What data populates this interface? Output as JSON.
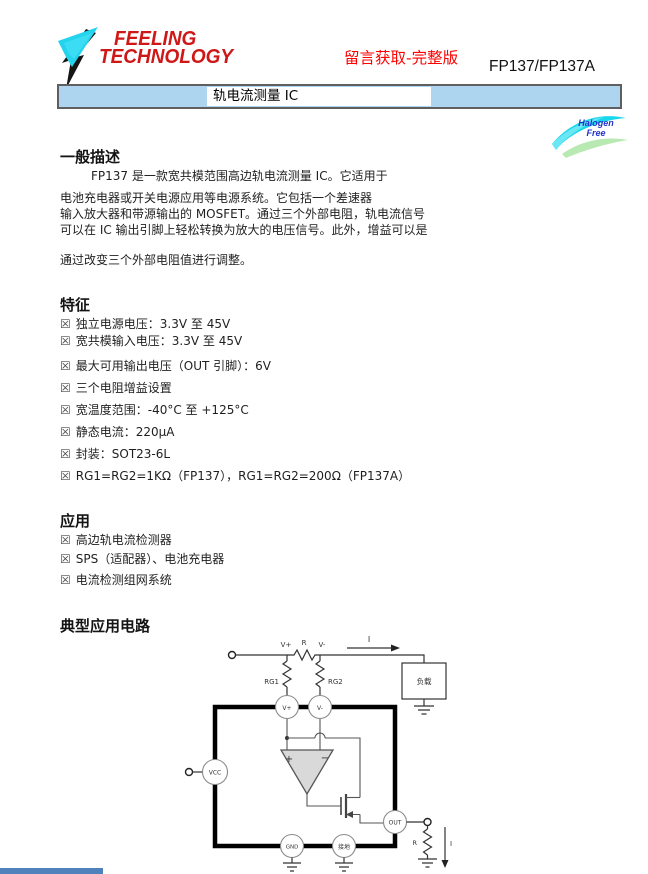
{
  "header": {
    "logo_line1": "FEELING",
    "logo_line2": "TECHNOLOGY",
    "promo_text": "留言获取-完整版",
    "part_number": "FP137/FP137A",
    "banner_title": "轨电流测量 IC",
    "badge_line1": "Halogen",
    "badge_line2": "Free"
  },
  "general": {
    "title": "一般描述",
    "line1": "FP137 是一款宽共模范围高边轨电流测量 IC。它适用于",
    "line2": "电池充电器或开关电源应用等电源系统。它包括一个差速器",
    "line3": "输入放大器和带源输出的 MOSFET。通过三个外部电阻，轨电流信号",
    "line4": "可以在 IC 输出引脚上轻松转换为放大的电压信号。此外，增益可以是",
    "line5": "通过改变三个外部电阻值进行调整。"
  },
  "features": {
    "title": "特征",
    "bullet": "☒",
    "item1": "独立电源电压：3.3V 至 45V",
    "item2": "宽共模输入电压：3.3V 至 45V",
    "item3": "最大可用输出电压（OUT 引脚）：6V",
    "item4": "三个电阻增益设置",
    "item5": "宽温度范围：-40°C 至 +125°C",
    "item6": "静态电流：220μA",
    "item7": "封装：SOT23-6L",
    "item8": "RG1=RG2=1KΩ（FP137），RG1=RG2=200Ω（FP137A）"
  },
  "applications": {
    "title": "应用",
    "bullet": "☒",
    "item1": "高边轨电流检测器",
    "item2": "SPS（适配器）、电池充电器",
    "item3": "电流检测组网系统"
  },
  "circuit": {
    "title": "典型应用电路",
    "labels": {
      "v_plus": "V+",
      "sense_res": "R",
      "v_minus": "V-",
      "current_in": "I",
      "load": "负载",
      "rg1": "RG1",
      "rg2": "RG2",
      "pin_vplus": "V+",
      "pin_vminus": "V-",
      "pin_vcc": "VCC",
      "pin_gnd": "GND",
      "pin_gnd2": "接地",
      "pin_out": "OUT",
      "opamp_plus": "+",
      "opamp_minus": "−",
      "out_res": "R",
      "current_out": "I"
    }
  },
  "colors": {
    "banner_blue": "#aed5f0",
    "logo_red": "#cf1717",
    "promo_red": "#ff0000",
    "badge_cyan": "#19d8ec",
    "badge_green": "#b9e9b2",
    "footer_blue": "#4f81bd"
  }
}
